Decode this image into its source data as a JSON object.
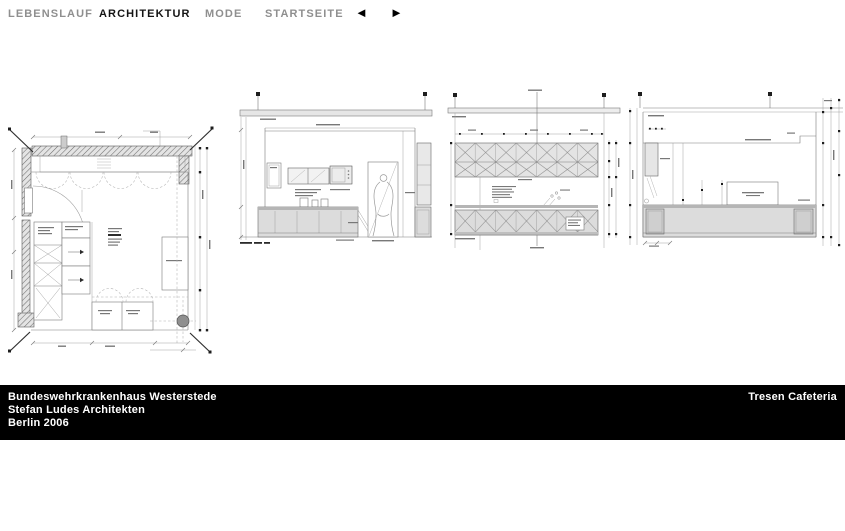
{
  "nav": {
    "items": [
      {
        "label": "LEBENSLAUF",
        "active": false
      },
      {
        "label": "ARCHITEKTUR",
        "active": true
      },
      {
        "label": "MODE",
        "active": false
      },
      {
        "label": "STARTSEITE",
        "active": false
      }
    ],
    "prev_icon": {
      "name": "left-arrow",
      "glyph": "◄"
    },
    "next_icon": {
      "name": "right-arrow",
      "glyph": "►"
    }
  },
  "footer": {
    "project": "Bundeswehrkrankenhaus Westerstede",
    "architect": "Stefan Ludes Architekten",
    "city_year": "Berlin 2006",
    "caption_right": "Tresen Cafeteria"
  },
  "colors": {
    "nav_inactive": "#8f8f8f",
    "nav_active": "#141414",
    "footer_bg": "#000000",
    "footer_text": "#ffffff",
    "drawing_line": "#7a7a7a",
    "drawing_fill": "#dcdcdc",
    "background": "#ffffff"
  }
}
